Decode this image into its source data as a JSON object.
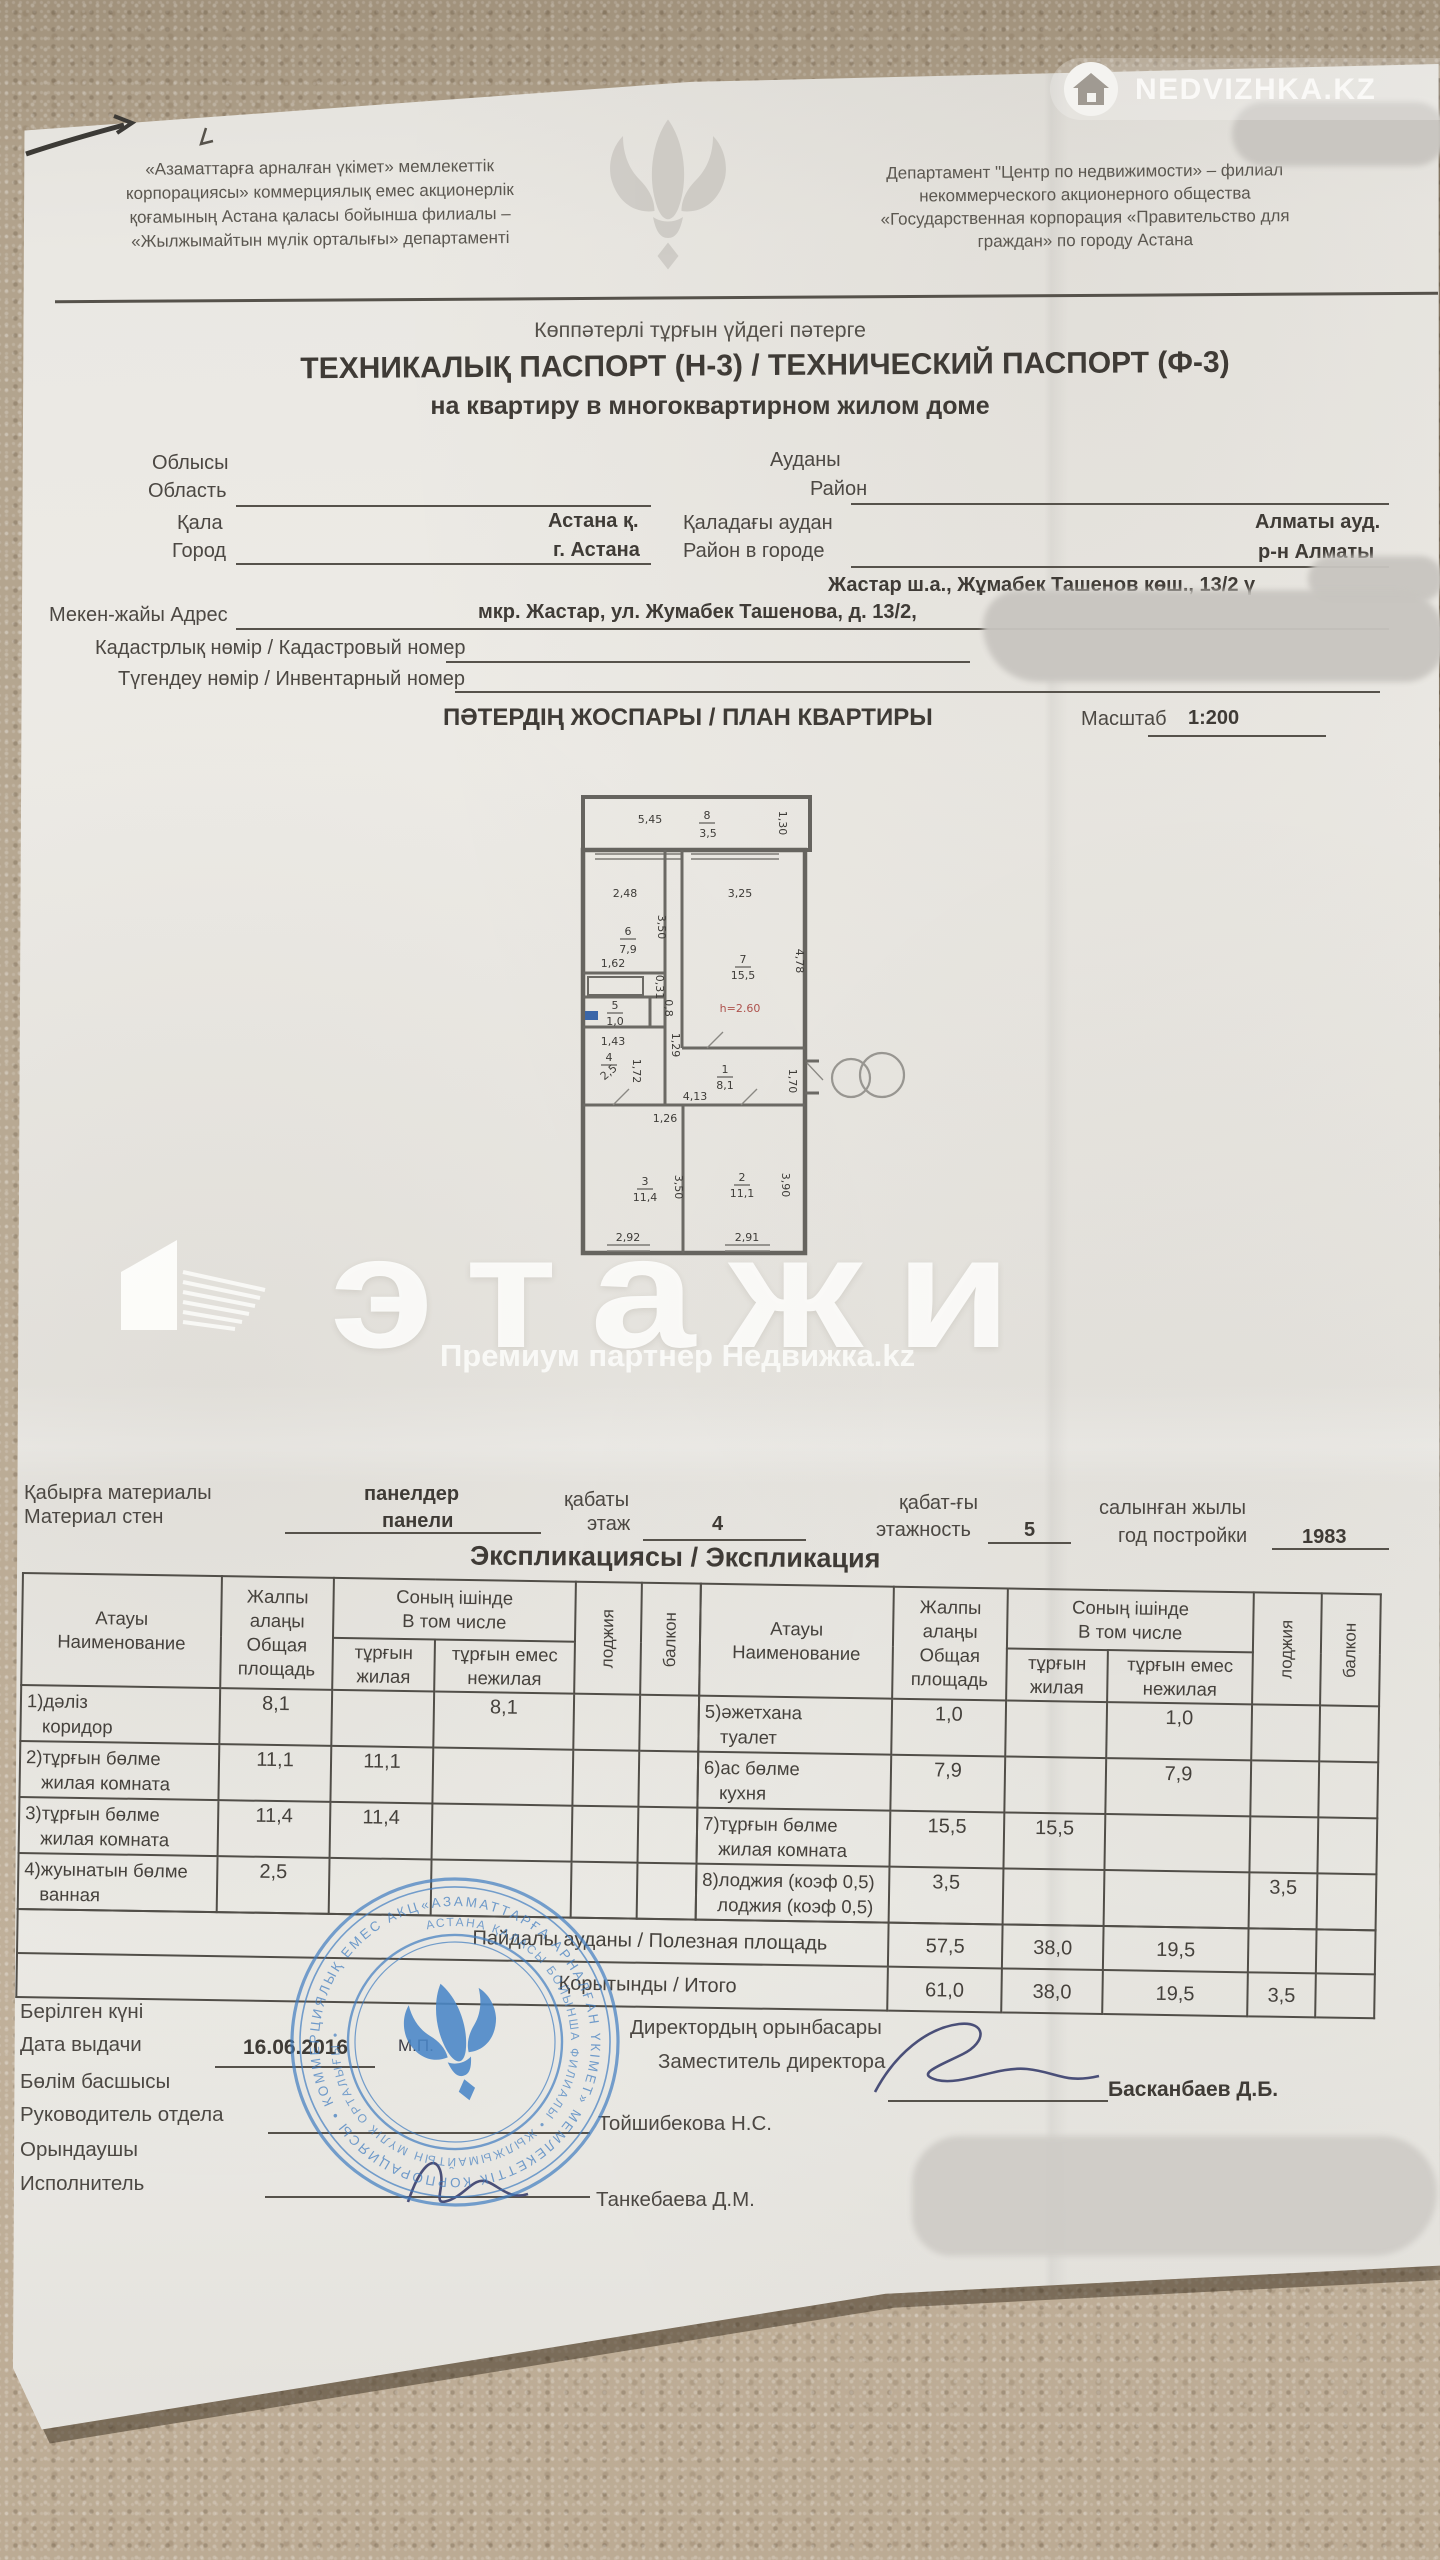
{
  "photo_watermarks": {
    "nedvizhka": {
      "brand": "NEDVIZHKA.KZ",
      "icon": "house-icon"
    },
    "etazhi": {
      "logo_text": "этажи",
      "subtitle": "Премиум партнер Недвижка.kz",
      "icon": "building-icon"
    }
  },
  "header": {
    "left_org": "«Азаматтарға арналған үкімет» мемлекеттік\nкорпорациясы» коммерциялық емес акционерлік\nқоғамының Астана қаласы бойынша филиалы –\n«Жылжымайтын мүлік орталығы» департаменті",
    "right_org": "Департамент \"Центр по недвижимости» – филиал\nнекоммерческого акционерного общества\n«Государственная корпорация «Правительство для\nграждан» по городу Астана",
    "emblem": "tulip-emblem"
  },
  "title": {
    "kz_small": "Көппәтерлі тұрғын үйдегі пәтерге",
    "main": "ТЕХНИКАЛЫҚ ПАСПОРТ (Н-3) / ТЕХНИЧЕСКИЙ ПАСПОРТ (Ф-3)",
    "ru_sub": "на квартиру в многоквартирном жилом доме"
  },
  "fields": {
    "region_kz": "Облысы",
    "region_ru": "Область",
    "district_kz": "Ауданы",
    "district_ru": "Район",
    "city_kz": "Қала",
    "city_value_kz": "Астана қ.",
    "city_district_kz": "Қаладағы аудан",
    "city_district_value_kz": "Алматы ауд.",
    "city_ru": "Город",
    "city_value_ru": "г. Астана",
    "city_district_ru": "Район в городе",
    "city_district_value_ru": "р-н Алматы",
    "address_kz_value": "Жастар ш.а., Жұмабек Ташенов көш., 13/2 ү",
    "address_label": "Мекен-жайы Адрес",
    "address_ru_value": "мкр. Жастар, ул. Жумабек Ташенова, д. 13/2,",
    "cadastral_label": "Кадастрлық нөмір / Кадастровый номер",
    "inventory_label": "Түгендеу нөмір / Инвентарный номер"
  },
  "plan": {
    "title": "ПӘТЕРДІҢ ЖОСПАРЫ / ПЛАН КВАРТИРЫ",
    "scale_label": "Масштаб",
    "scale_value": "1:200",
    "labels": [
      {
        "t": "5,45",
        "x": 95,
        "y": 48
      },
      {
        "t": "8",
        "x": 152,
        "y": 44,
        "bar": true
      },
      {
        "t": "3,5",
        "x": 153,
        "y": 62
      },
      {
        "t": "1,30",
        "x": 224,
        "y": 48,
        "rot": 90
      },
      {
        "t": "2,48",
        "x": 70,
        "y": 122
      },
      {
        "t": "6",
        "x": 73,
        "y": 160,
        "bar": true
      },
      {
        "t": "7,9",
        "x": 73,
        "y": 178
      },
      {
        "t": "3,50",
        "x": 103,
        "y": 152,
        "rot": 90
      },
      {
        "t": "1,62",
        "x": 58,
        "y": 192
      },
      {
        "t": "0,31",
        "x": 101,
        "y": 212,
        "rot": 90
      },
      {
        "t": "5",
        "x": 60,
        "y": 234,
        "bar": true
      },
      {
        "t": "1,0",
        "x": 60,
        "y": 250
      },
      {
        "t": "0,8",
        "x": 110,
        "y": 233,
        "rot": 90
      },
      {
        "t": "1,43",
        "x": 58,
        "y": 270
      },
      {
        "t": "4",
        "x": 54,
        "y": 286,
        "bar": true
      },
      {
        "t": "2,5",
        "x": 56,
        "y": 300,
        "rot": -40
      },
      {
        "t": "1,72",
        "x": 78,
        "y": 296,
        "rot": 90
      },
      {
        "t": "1,29",
        "x": 117,
        "y": 270,
        "rot": 90
      },
      {
        "t": "3,25",
        "x": 185,
        "y": 122
      },
      {
        "t": "7",
        "x": 188,
        "y": 188,
        "bar": true
      },
      {
        "t": "15,5",
        "x": 188,
        "y": 204
      },
      {
        "t": "4,78",
        "x": 241,
        "y": 186,
        "rot": 90
      },
      {
        "t": "h=2.60",
        "x": 185,
        "y": 237,
        "red": true,
        "size": 13
      },
      {
        "t": "1",
        "x": 170,
        "y": 298,
        "bar": true
      },
      {
        "t": "8,1",
        "x": 170,
        "y": 314
      },
      {
        "t": "4,13",
        "x": 140,
        "y": 325
      },
      {
        "t": "1,26",
        "x": 110,
        "y": 347
      },
      {
        "t": "1,70",
        "x": 234,
        "y": 306,
        "rot": 90
      },
      {
        "t": "3",
        "x": 90,
        "y": 410,
        "bar": true
      },
      {
        "t": "11,4",
        "x": 90,
        "y": 426
      },
      {
        "t": "3,50",
        "x": 120,
        "y": 412,
        "rot": 90
      },
      {
        "t": "2",
        "x": 187,
        "y": 406,
        "bar": true
      },
      {
        "t": "11,1",
        "x": 187,
        "y": 422
      },
      {
        "t": "3,90",
        "x": 227,
        "y": 410,
        "rot": 90
      },
      {
        "t": "2,92",
        "x": 73,
        "y": 466,
        "size": 10
      },
      {
        "t": "2,91",
        "x": 192,
        "y": 466,
        "size": 10
      }
    ]
  },
  "materials": {
    "wall_label_kz": "Қабырға материалы",
    "wall_label_ru": "Материал стен",
    "wall_value_kz": "панелдер",
    "wall_value_ru": "панели",
    "floor_label_kz": "қабаты",
    "floor_label_ru": "этаж",
    "floor_value": "4",
    "floors_label_kz": "қабат-ғы",
    "floors_label_ru": "этажность",
    "floors_value": "5",
    "year_label_kz": "салынған жылы",
    "year_label_ru": "год постройки",
    "year_value": "1983"
  },
  "explication": {
    "heading": "Экспликациясы / Экспликация",
    "headers": {
      "name": "Атауы\nНаименование",
      "total": "Жалпы\nалаңы\nОбщая\nплощадь",
      "including": "Соның ішінде\nВ том числе",
      "living": "тұрғын\nжилая",
      "nonliving": "тұрғын емес\nнежилая",
      "loggia": "лоджия",
      "balcony": "балкон"
    },
    "left_rows": [
      {
        "name": "1)дәліз\n   коридор",
        "total": "8,1",
        "living": "",
        "nonliving": "8,1",
        "loggia": "",
        "balcony": ""
      },
      {
        "name": "2)тұрғын бөлме\n   жилая комната",
        "total": "11,1",
        "living": "11,1",
        "nonliving": "",
        "loggia": "",
        "balcony": ""
      },
      {
        "name": "3)тұрғын бөлме\n   жилая комната",
        "total": "11,4",
        "living": "11,4",
        "nonliving": "",
        "loggia": "",
        "balcony": ""
      },
      {
        "name": "4)жуынатын бөлме\n   ванная",
        "total": "2,5",
        "living": "",
        "nonliving": "",
        "loggia": "",
        "balcony": ""
      }
    ],
    "right_rows": [
      {
        "name": "5)әжетхана\n   туалет",
        "total": "1,0",
        "living": "",
        "nonliving": "1,0",
        "loggia": "",
        "balcony": ""
      },
      {
        "name": "6)ас бөлме\n   кухня",
        "total": "7,9",
        "living": "",
        "nonliving": "7,9",
        "loggia": "",
        "balcony": ""
      },
      {
        "name": "7)тұрғын бөлме\n   жилая комната",
        "total": "15,5",
        "living": "15,5",
        "n onliving": "",
        "nonliving": "",
        "loggia": "",
        "balcony": ""
      },
      {
        "name": "8)лоджия (коэф 0,5)\n   лоджия (коэф 0,5)",
        "total": "3,5",
        "living": "",
        "nonliving": "",
        "loggia": "3,5",
        "balcony": ""
      }
    ],
    "totals": [
      {
        "label": "Пайдалы ауданы / Полезная площадь",
        "total": "57,5",
        "living": "38,0",
        "nonliving": "19,5",
        "loggia": "",
        "balcony": ""
      },
      {
        "label": "Қорытынды / Итого",
        "total": "61,0",
        "living": "38,0",
        "nonliving": "19,5",
        "loggia": "3,5",
        "balcony": ""
      }
    ]
  },
  "footer": {
    "issue_date_label_kz": "Берілген күні",
    "issue_date_label_ru": "Дата выдачи",
    "issue_date_value": "16.06.2016",
    "dept_head_label_kz": "Бөлім басшысы",
    "dept_head_label_ru": "Руководитель отдела",
    "dept_head_name": "Тойшибекова Н.С.",
    "executor_label_kz": "Орындаушы",
    "executor_label_ru": "Исполнитель",
    "executor_name": "Танкебаева Д.М.",
    "deputy_label_kz": "Директордың орынбасары",
    "deputy_label_ru": "Заместитель директора",
    "deputy_name": "Басканбаев Д.Б.",
    "stamp_mp": "М.П.",
    "stamp_ring_outer": "«АЗАМАТТАРҒА АРНАЛҒАН ҮКІМЕТ» МЕМЛЕКЕТТІК КОРПОРАЦИЯСЫ • КОММЕРЦИЯЛЫҚ ЕМЕС АКЦИОНЕРЛІК ҚОҒАМЫ • ",
    "stamp_ring_inner": "АСТАНА ҚАЛАСЫ БОЙЫНША ФИЛИАЛЫ • ЖЫЛЖЫМАЙТЫН МҮЛІК ОРТАЛЫҒЫ • "
  },
  "colors": {
    "stamp_blue": "#3f7cc0",
    "plan_red": "#ae524d",
    "paper": "#eae8e3",
    "carpet": "#b3a28c"
  }
}
